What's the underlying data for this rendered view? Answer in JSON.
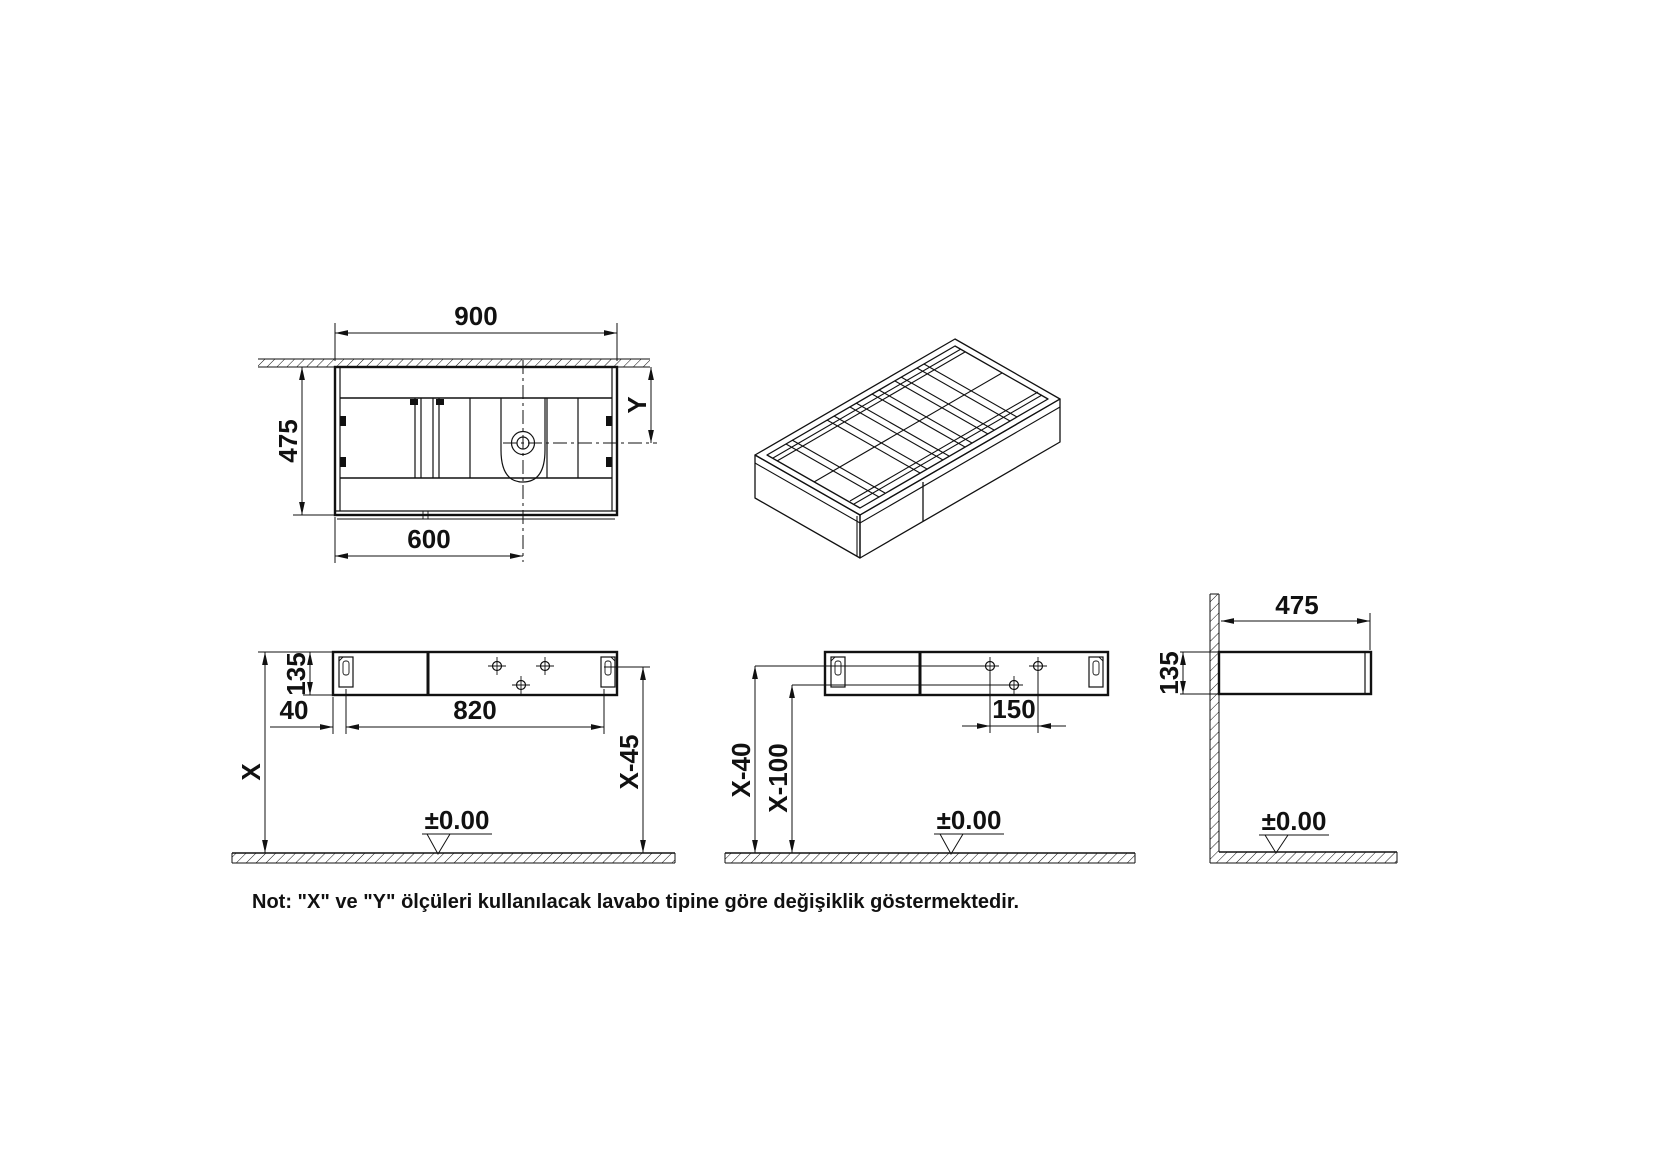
{
  "note": "Not: \"X\" ve \"Y\" ölçüleri kullanılacak lavabo tipine göre değişiklik göstermektedir.",
  "colors": {
    "line": "#111111",
    "background": "#ffffff"
  },
  "dimensions": {
    "plan": {
      "width": "900",
      "depth": "475",
      "sink_center_from_left": "600",
      "sink_center_from_wall": "Y"
    },
    "front_left": {
      "cabinet_height": "135",
      "bracket_inset": "40",
      "bracket_spacing": "820",
      "install_height": "X",
      "bracket_level": "X-45",
      "floor_datum": "±0.00"
    },
    "front_right": {
      "upper_holes_level": "X-40",
      "lower_hole_level": "X-100",
      "hole_spacing": "150",
      "floor_datum": "±0.00"
    },
    "side": {
      "depth": "475",
      "height": "135",
      "floor_datum": "±0.00"
    }
  }
}
